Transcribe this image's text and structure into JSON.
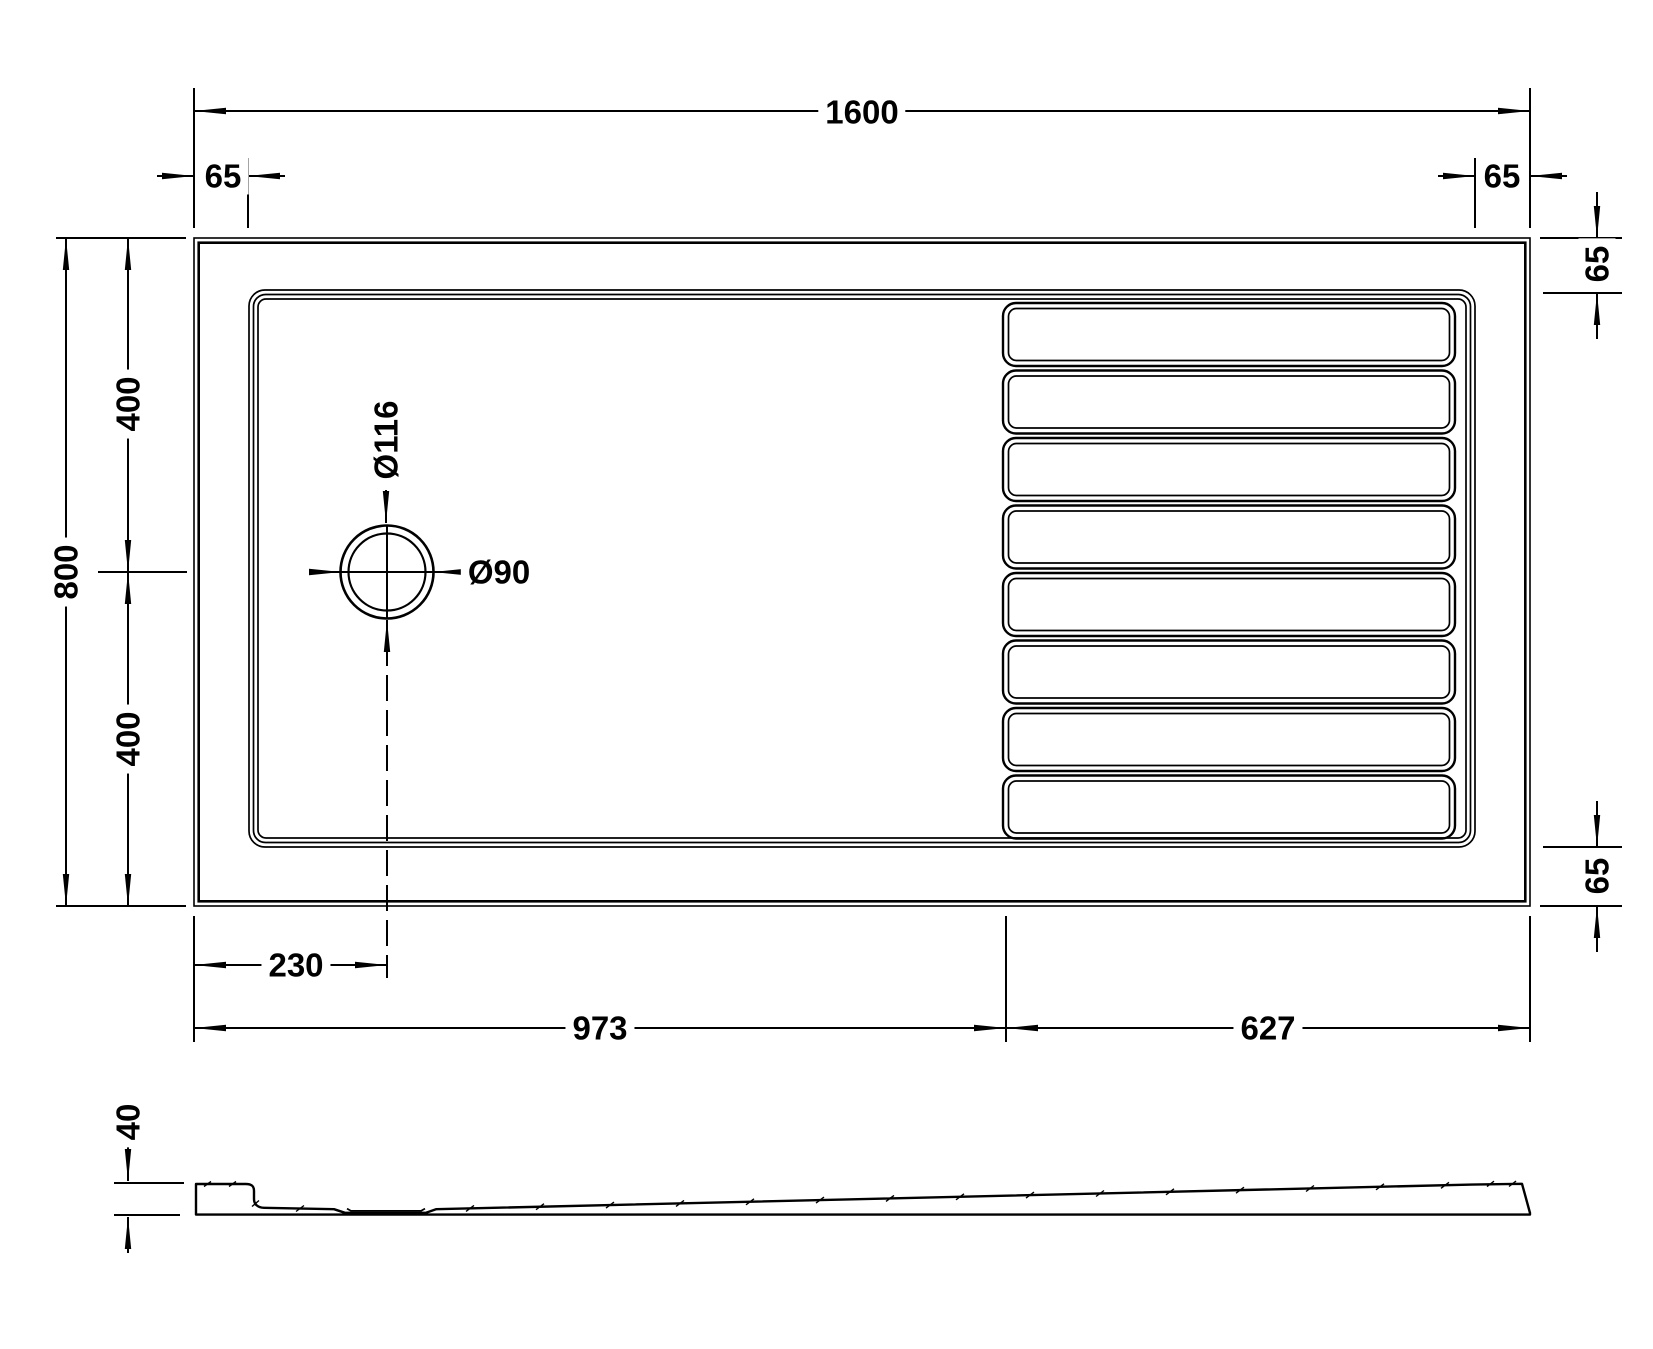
{
  "plan": {
    "overall_width": "1600",
    "rim_left": "65",
    "rim_right": "65",
    "overall_depth": "800",
    "depth_upper": "400",
    "depth_lower": "400",
    "rim_top_right": "65",
    "rim_bottom_right": "65",
    "waste_outer_diameter": "Ø116",
    "waste_diameter": "Ø90",
    "waste_offset_from_left": "230",
    "smooth_section_length": "973",
    "ribbed_section_length": "627"
  },
  "side": {
    "tray_height": "40"
  },
  "colors": {
    "line": "#000000",
    "background": "#ffffff"
  }
}
